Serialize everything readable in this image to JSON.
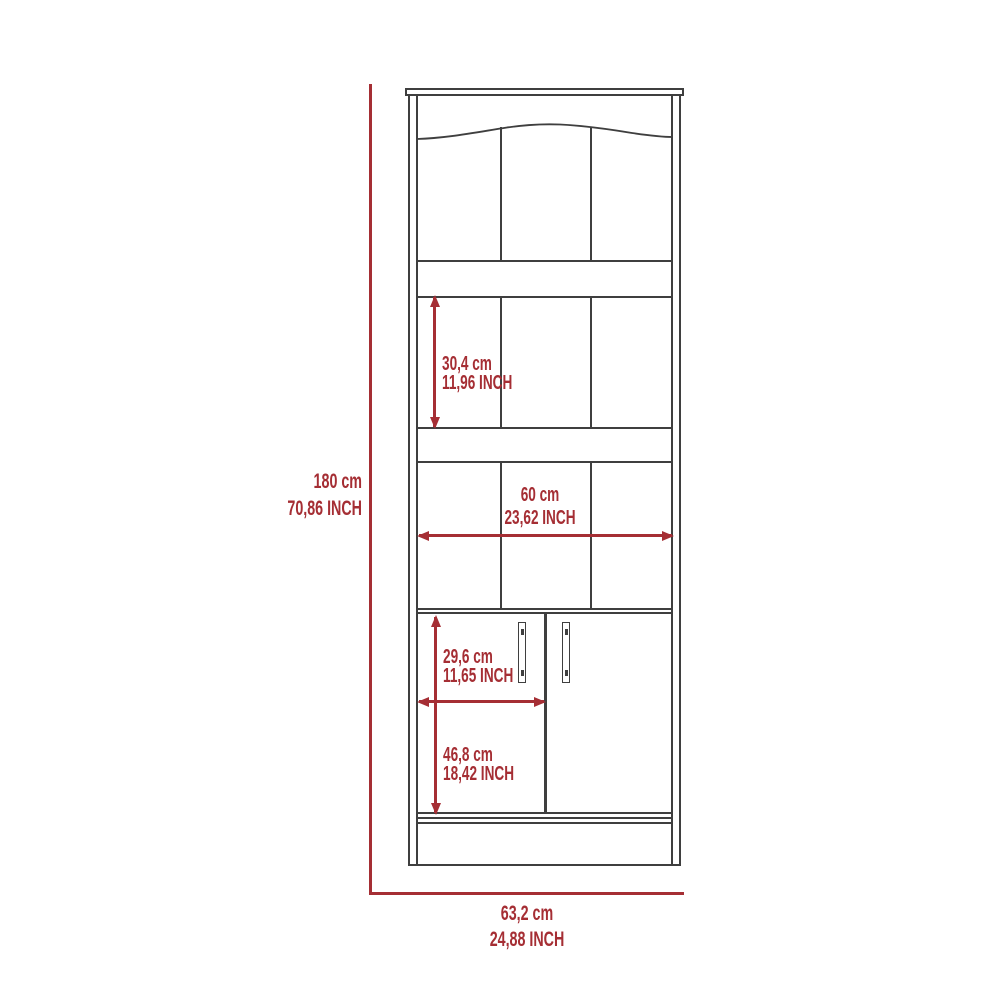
{
  "colors": {
    "outline": "#3f3f3f",
    "dimension_red": "#a52e34",
    "background": "#ffffff"
  },
  "dims": {
    "overall_height": {
      "cm": "180 cm",
      "inch": "70,86 INCH"
    },
    "overall_width": {
      "cm": "63,2 cm",
      "inch": "24,88 INCH"
    },
    "shelf_height": {
      "cm": "30,4 cm",
      "inch": "11,96 INCH"
    },
    "interior_width": {
      "cm": "60 cm",
      "inch": "23,62 INCH"
    },
    "door_width": {
      "cm": "29,6 cm",
      "inch": "11,65 INCH"
    },
    "door_height": {
      "cm": "46,8 cm",
      "inch": "18,42 INCH"
    }
  }
}
